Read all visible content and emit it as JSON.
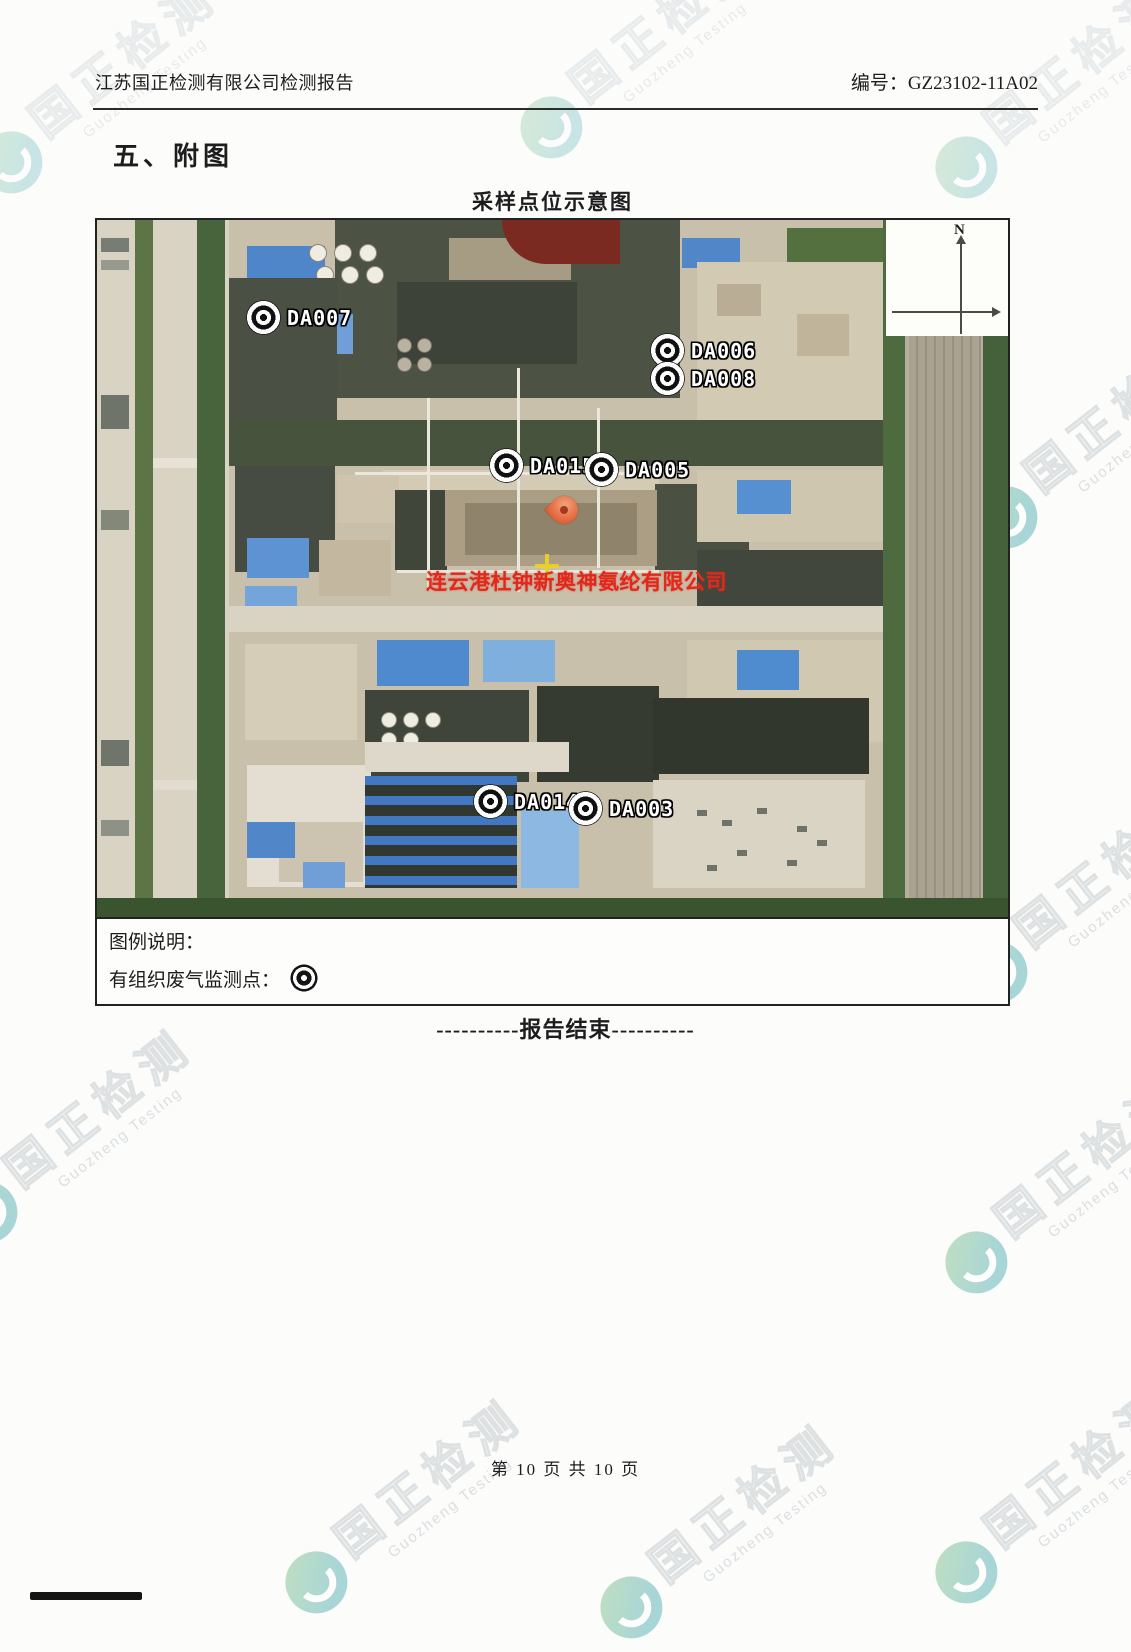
{
  "header": {
    "report_title": "江苏国正检测有限公司检测报告",
    "report_number": "编号：GZ23102-11A02"
  },
  "section_heading": "五、附图",
  "map": {
    "title": "采样点位示意图",
    "compass_label": "N",
    "company_overlay": "连云港杜钟新奥神氨纶有限公司",
    "points": [
      {
        "label": "DA007"
      },
      {
        "label": "DA006"
      },
      {
        "label": "DA008"
      },
      {
        "label": "DA015"
      },
      {
        "label": "DA005"
      },
      {
        "label": "DA014"
      },
      {
        "label": "DA003"
      }
    ]
  },
  "legend": {
    "heading": "图例说明：",
    "item_label": "有组织废气监测点："
  },
  "report_end": "----------报告结束----------",
  "footer": {
    "page_info": "第 10 页 共 10 页"
  },
  "watermark": {
    "cn": "国正检测",
    "en": "Guozheng Testing"
  },
  "colors": {
    "overlay_red": "#e1281b",
    "pin": "#e46a41",
    "logo_teal": "#37a2a6"
  }
}
